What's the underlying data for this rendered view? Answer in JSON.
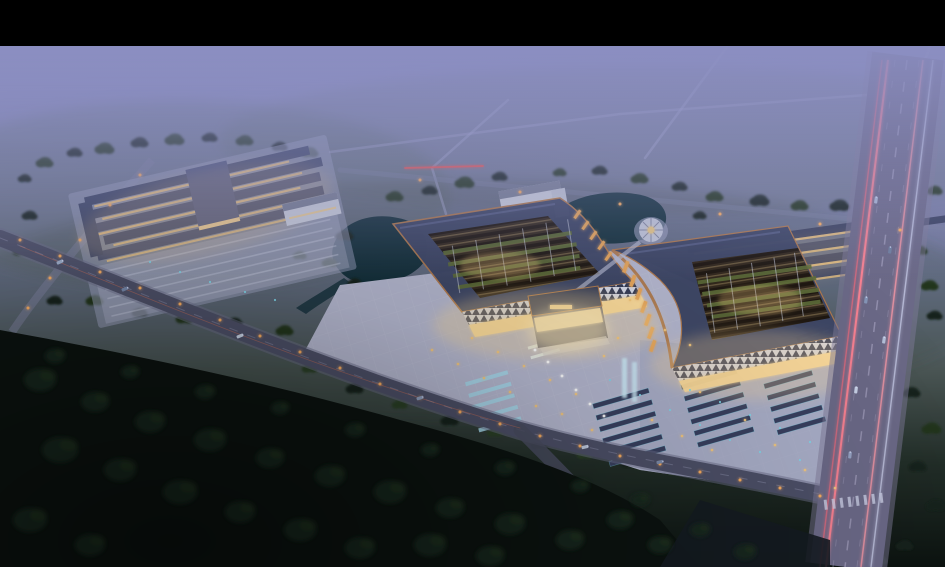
{
  "meta": {
    "description": "Aerial dusk architectural rendering of a large Chinese-style market / exhibition complex: two sweeping-roof halls with open lattice courtyards, a lit plaza with fountains and parking, a secondary retail complex to the west, dormitory rows and a round pavilion by ponds to the north, a wide boulevard with light trails on the east, misty fields above and a dark forest foreground. Black letterbox bar across the top. No readable text in the image.",
    "canvas": {
      "width": 945,
      "height": 567,
      "letterbox_top_px": 46
    }
  },
  "palette": {
    "letterbox": "#000000",
    "mist": "#8b8ec1",
    "mist_mid": "#7b80a8",
    "ground_green": "#55635a",
    "field_green": "#41503f",
    "tree_green": "#24351f",
    "tree_dark": "#16231a",
    "tree_rim": "#2c4027",
    "forest_blob": "#18281c",
    "forest_night": "#0c1310",
    "water": "#15313c",
    "plaza": "#b5b8d0",
    "plaza_shade": "#9ea3c2",
    "roof": "#3e4766",
    "roof_ridge": "#5d668e",
    "copper": "#b07a4e",
    "lattice_dark": "#33291e",
    "planting": "#5f6e3a",
    "glow_warm": "#f4c87e",
    "glow_bright": "#ffe9b8",
    "white_wall": "#cdd1dd",
    "canopy": "#d6daea",
    "road": "#4d5068",
    "road_light": "#7d82a0",
    "avenue": "#6b6987",
    "lane_mark": "#9c99b6",
    "trail_pink": "#ff8392",
    "trail_red": "#ff5148",
    "street_orange": "#ffb060",
    "cyan": "#7fd8ea",
    "fountain": "#a8dcef",
    "car_light": "#dfe3ff"
  },
  "scene": {
    "type": "architectural-aerial-rendering",
    "time_of_day": "dusk",
    "elements": [
      "letterbox-bar",
      "misty-horizon",
      "distant-field-roads",
      "west-retail-complex",
      "white-office-buildings",
      "ponds",
      "round-pavilion",
      "dormitory-rows",
      "east-hall",
      "west-hall",
      "gatehouse",
      "front-plaza",
      "fountain-strips",
      "parking-strips",
      "front-road",
      "boulevard",
      "forest-foreground"
    ],
    "trees": [
      [
        45,
        162,
        9,
        "a"
      ],
      [
        75,
        152,
        8,
        "b"
      ],
      [
        105,
        148,
        10,
        "a"
      ],
      [
        140,
        142,
        9,
        "b"
      ],
      [
        175,
        139,
        10,
        "a"
      ],
      [
        210,
        137,
        8,
        "b"
      ],
      [
        245,
        140,
        9,
        "a"
      ],
      [
        280,
        146,
        8,
        "b"
      ],
      [
        310,
        152,
        9,
        "a"
      ],
      [
        25,
        178,
        7,
        "b"
      ],
      [
        30,
        215,
        8,
        "b"
      ],
      [
        22,
        250,
        9,
        "a"
      ],
      [
        55,
        300,
        8,
        "b"
      ],
      [
        95,
        300,
        9,
        "a"
      ],
      [
        140,
        312,
        8,
        "b"
      ],
      [
        185,
        318,
        9,
        "a"
      ],
      [
        235,
        322,
        8,
        "b"
      ],
      [
        285,
        330,
        9,
        "a"
      ],
      [
        330,
        345,
        8,
        "b"
      ],
      [
        345,
        235,
        9,
        "b"
      ],
      [
        330,
        262,
        8,
        "a"
      ],
      [
        355,
        282,
        7,
        "b"
      ],
      [
        300,
        255,
        7,
        "a"
      ],
      [
        395,
        196,
        9,
        "a"
      ],
      [
        430,
        190,
        8,
        "b"
      ],
      [
        465,
        182,
        10,
        "a"
      ],
      [
        500,
        176,
        8,
        "b"
      ],
      [
        560,
        172,
        7,
        "a"
      ],
      [
        600,
        170,
        8,
        "b"
      ],
      [
        640,
        178,
        9,
        "a"
      ],
      [
        680,
        186,
        8,
        "b"
      ],
      [
        715,
        196,
        9,
        "a"
      ],
      [
        760,
        200,
        10,
        "b"
      ],
      [
        800,
        205,
        9,
        "a"
      ],
      [
        840,
        205,
        10,
        "b"
      ],
      [
        875,
        210,
        9,
        "a"
      ],
      [
        910,
        200,
        10,
        "b"
      ],
      [
        935,
        190,
        8,
        "a"
      ],
      [
        700,
        215,
        7,
        "b"
      ],
      [
        930,
        285,
        9,
        "a"
      ],
      [
        935,
        315,
        8,
        "b"
      ],
      [
        920,
        250,
        8,
        "a"
      ],
      [
        310,
        368,
        8,
        "c"
      ],
      [
        355,
        388,
        9,
        "b"
      ],
      [
        400,
        404,
        8,
        "c"
      ],
      [
        450,
        420,
        9,
        "b"
      ],
      [
        495,
        432,
        8,
        "c"
      ],
      [
        540,
        444,
        9,
        "b"
      ],
      [
        585,
        454,
        8,
        "c"
      ],
      [
        630,
        462,
        9,
        "b"
      ],
      [
        675,
        470,
        8,
        "c"
      ],
      [
        720,
        478,
        9,
        "b"
      ],
      [
        765,
        486,
        8,
        "c"
      ],
      [
        912,
        392,
        9,
        "b"
      ],
      [
        932,
        428,
        10,
        "a"
      ],
      [
        918,
        466,
        9,
        "b"
      ],
      [
        936,
        505,
        10,
        "b"
      ],
      [
        905,
        545,
        9,
        "b"
      ],
      [
        880,
        560,
        8,
        "b"
      ],
      [
        800,
        425,
        8,
        "b"
      ],
      [
        788,
        462,
        7,
        "b"
      ],
      [
        812,
        392,
        7,
        "b"
      ]
    ],
    "forest": [
      [
        40,
        380,
        16
      ],
      [
        95,
        402,
        14
      ],
      [
        150,
        422,
        15
      ],
      [
        210,
        440,
        16
      ],
      [
        270,
        458,
        14
      ],
      [
        330,
        476,
        15
      ],
      [
        390,
        492,
        16
      ],
      [
        450,
        508,
        14
      ],
      [
        510,
        524,
        15
      ],
      [
        570,
        540,
        14
      ],
      [
        60,
        450,
        18
      ],
      [
        120,
        470,
        16
      ],
      [
        180,
        492,
        17
      ],
      [
        240,
        512,
        15
      ],
      [
        300,
        530,
        16
      ],
      [
        360,
        548,
        15
      ],
      [
        30,
        520,
        17
      ],
      [
        90,
        545,
        15
      ],
      [
        430,
        545,
        16
      ],
      [
        490,
        556,
        14
      ],
      [
        620,
        520,
        13
      ],
      [
        660,
        545,
        12
      ],
      [
        700,
        530,
        10
      ],
      [
        745,
        552,
        11
      ],
      [
        55,
        356,
        10
      ],
      [
        130,
        372,
        9
      ],
      [
        205,
        392,
        10
      ],
      [
        280,
        408,
        9
      ],
      [
        355,
        430,
        10
      ],
      [
        430,
        450,
        9
      ],
      [
        505,
        468,
        10
      ],
      [
        580,
        486,
        9
      ],
      [
        640,
        500,
        9
      ]
    ],
    "street_lights": [
      [
        20,
        240
      ],
      [
        60,
        256
      ],
      [
        100,
        272
      ],
      [
        140,
        288
      ],
      [
        180,
        304
      ],
      [
        220,
        320
      ],
      [
        260,
        336
      ],
      [
        300,
        352
      ],
      [
        340,
        368
      ],
      [
        380,
        384
      ],
      [
        420,
        398
      ],
      [
        460,
        412
      ],
      [
        500,
        424
      ],
      [
        540,
        436
      ],
      [
        580,
        446
      ],
      [
        620,
        456
      ],
      [
        660,
        464
      ],
      [
        700,
        472
      ],
      [
        740,
        480
      ],
      [
        780,
        488
      ],
      [
        820,
        496
      ],
      [
        140,
        175
      ],
      [
        110,
        205
      ],
      [
        80,
        240
      ],
      [
        50,
        278
      ],
      [
        28,
        308
      ],
      [
        420,
        180
      ],
      [
        520,
        192
      ],
      [
        620,
        204
      ],
      [
        720,
        214
      ],
      [
        820,
        224
      ],
      [
        900,
        230
      ]
    ],
    "plaza_lights": [
      [
        432,
        350
      ],
      [
        458,
        364
      ],
      [
        484,
        378
      ],
      [
        510,
        392
      ],
      [
        536,
        406
      ],
      [
        472,
        338
      ],
      [
        498,
        352
      ],
      [
        524,
        366
      ],
      [
        550,
        380
      ],
      [
        576,
        394
      ],
      [
        604,
        356
      ],
      [
        630,
        300
      ],
      [
        652,
        420
      ],
      [
        682,
        436
      ],
      [
        712,
        450
      ],
      [
        592,
        430
      ],
      [
        562,
        414
      ],
      [
        618,
        338
      ],
      [
        700,
        392
      ],
      [
        745,
        420
      ],
      [
        775,
        445
      ],
      [
        805,
        470
      ],
      [
        835,
        488
      ],
      [
        665,
        330
      ],
      [
        690,
        345
      ]
    ],
    "parking_lights": [
      [
        610,
        380
      ],
      [
        640,
        395
      ],
      [
        670,
        410
      ],
      [
        700,
        425
      ],
      [
        730,
        440
      ],
      [
        760,
        452
      ],
      [
        690,
        390
      ],
      [
        720,
        402
      ],
      [
        750,
        415
      ],
      [
        780,
        428
      ],
      [
        810,
        442
      ],
      [
        800,
        460
      ],
      [
        150,
        262
      ],
      [
        180,
        272
      ],
      [
        210,
        282
      ],
      [
        245,
        292
      ],
      [
        275,
        300
      ]
    ],
    "fountain_lights": [
      [
        548,
        362
      ],
      [
        562,
        376
      ],
      [
        576,
        390
      ],
      [
        590,
        404
      ],
      [
        535,
        350
      ],
      [
        604,
        416
      ]
    ],
    "cars": [
      [
        60,
        262,
        -24,
        "#9fb0cc"
      ],
      [
        125,
        289,
        -24,
        "#7486a8"
      ],
      [
        240,
        336,
        -22,
        "#c7d2e4"
      ],
      [
        420,
        398,
        -18,
        "#8fa0bf"
      ],
      [
        585,
        447,
        -14,
        "#c0cade"
      ],
      [
        660,
        462,
        -12,
        "#7d8cab"
      ],
      [
        876,
        200,
        -82,
        "#aab6d2"
      ],
      [
        866,
        300,
        -82,
        "#8494b6"
      ],
      [
        856,
        390,
        -83,
        "#c7d0e6"
      ],
      [
        850,
        455,
        -84,
        "#95a2c2"
      ],
      [
        890,
        250,
        -82,
        "#6f7f9e"
      ],
      [
        884,
        340,
        -82,
        "#b4bfd8"
      ]
    ]
  }
}
